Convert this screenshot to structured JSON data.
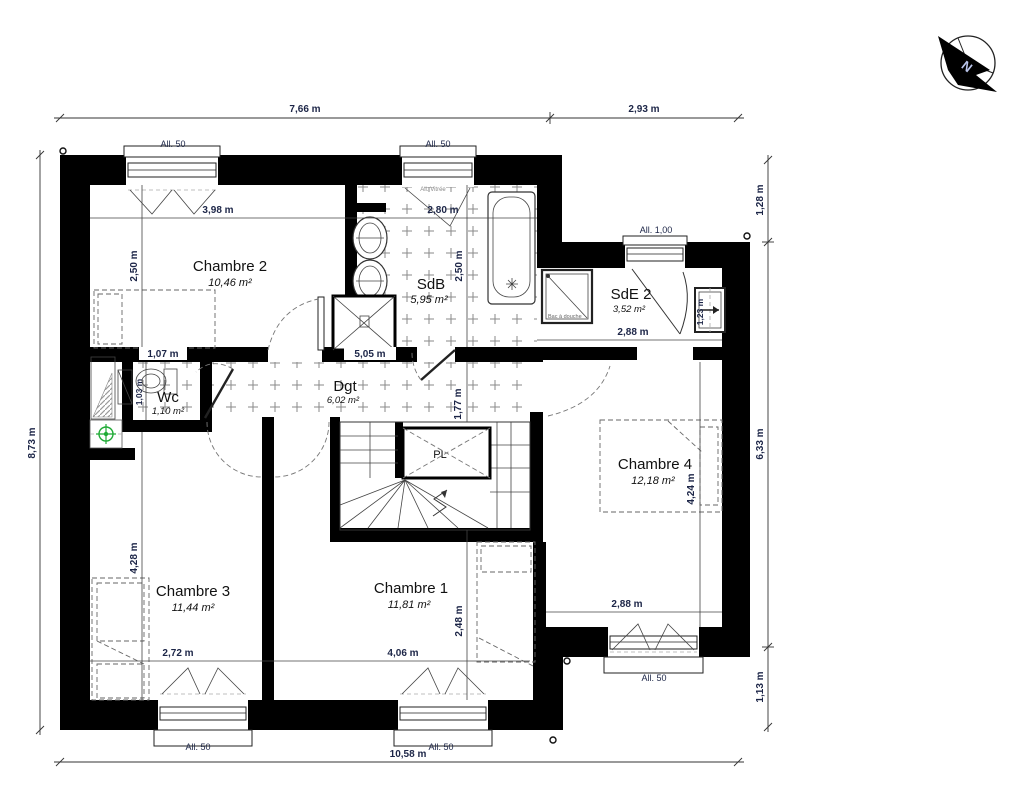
{
  "compass": {
    "north_label": "N"
  },
  "rooms": {
    "chambre2": {
      "name": "Chambre 2",
      "area": "10,46 m²"
    },
    "sdb": {
      "name": "SdB",
      "area": "5,95 m²"
    },
    "sde2": {
      "name": "SdE 2",
      "area": "3,52 m²"
    },
    "wc": {
      "name": "Wc",
      "area": "1,10 m²"
    },
    "dgt": {
      "name": "Dgt",
      "area": "6,02 m²"
    },
    "chambre4": {
      "name": "Chambre 4",
      "area": "12,18 m²"
    },
    "chambre3": {
      "name": "Chambre 3",
      "area": "11,44 m²"
    },
    "chambre1": {
      "name": "Chambre 1",
      "area": "11,81 m²"
    }
  },
  "exterior_dims": {
    "top_left": "7,66 m",
    "top_right": "2,93 m",
    "left": "8,73 m",
    "bottom": "10,58 m",
    "right_top": "1,28 m",
    "right_mid": "6,33 m",
    "right_bottom": "1,13 m"
  },
  "interior_dims": {
    "ch2_width": "3,98 m",
    "sdb_width": "2,80 m",
    "ch2_depth": "2,50 m",
    "sdb_depth": "2,50 m",
    "corridor_left": "1,07 m",
    "corridor_right": "5,05 m",
    "wc_depth": "1,03 m",
    "dgt_depth": "1,77 m",
    "ch3_width": "2,72 m",
    "ch1_width": "4,06 m",
    "ch3_depth": "4,28 m",
    "ch1_depth": "2,48 m",
    "sde2_width": "2,88 m",
    "ch4_width": "2,88 m",
    "ch4_depth": "4,24 m",
    "radiator_height": "1,23 m"
  },
  "windows": {
    "w1": "All. 50",
    "w2": "All. 50",
    "w3": "All. 1,00",
    "w4": "All. 50",
    "w5": "All. 50",
    "w6": "All. 50",
    "glazed": "All. Vitrée"
  },
  "fixtures": {
    "shower_tray": "Bac à douche",
    "closet": "PL"
  },
  "colors": {
    "wall": "#000000",
    "dim_text": "#1c2547",
    "vent_symbol": "#1faa35",
    "tile_pattern": "#8a8a8a"
  }
}
